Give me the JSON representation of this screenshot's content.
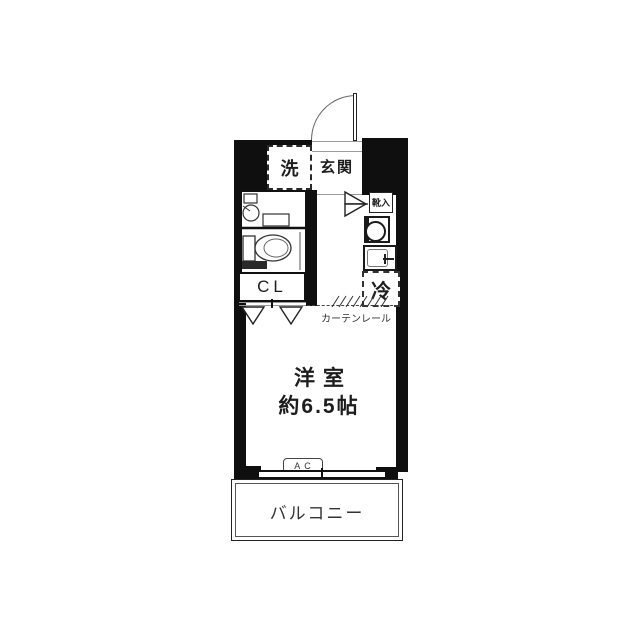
{
  "floorplan": {
    "rooms": {
      "entrance": "玄関",
      "washer": "洗",
      "shoe_storage": "靴入",
      "closet": "CL",
      "refrigerator": "冷",
      "curtain_rail": "カーテンレール",
      "main_room_name": "洋室",
      "main_room_size": "約6.5帖",
      "air_conditioner": "AC",
      "balcony": "バルコニー"
    },
    "colors": {
      "wall": "#0f0f0f",
      "outline": "#333333",
      "text": "#1d1d1d"
    }
  }
}
